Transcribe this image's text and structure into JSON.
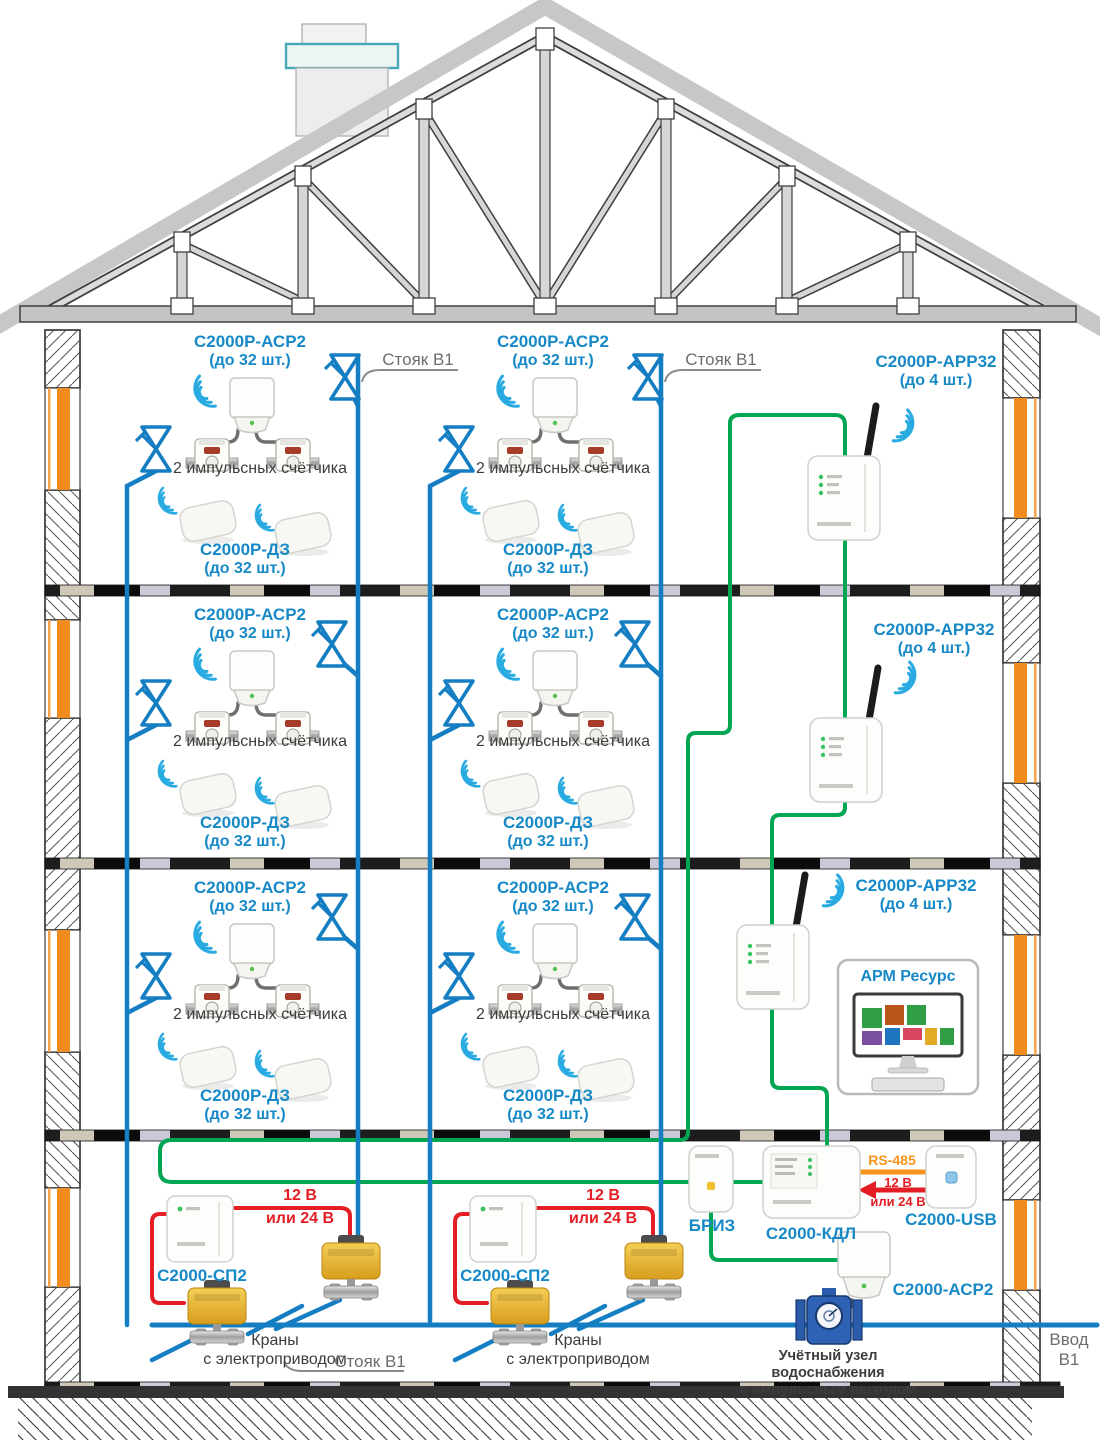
{
  "title": "Схема радиоканальной системы учёта воды в многоэтажном доме",
  "texts": {
    "acp2": "С2000Р-АСР2",
    "qty_32": "(до 32 шт.)",
    "meters": "2 импульсных счётчика",
    "dz": "С2000Р-ДЗ",
    "riser": "Стояк В1",
    "app32": "С2000Р-АРР32",
    "qty_4": "(до 4 шт.)",
    "arm": "АРМ Ресурс",
    "sp2": "С2000-СП2",
    "v12": "12 В",
    "v24": "или 24 В",
    "valves_1": "Краны",
    "valves_2": "с электроприводом",
    "briz": "БРИЗ",
    "kdl": "С2000-КДЛ",
    "rs485": "RS-485",
    "usb": "С2000-USB",
    "acp2_entry": "С2000-АСР2",
    "entry_unit_1": "Учётный узел водоснабжения",
    "entry_unit_2": "с импульсным выходом",
    "entry": "Ввод В1"
  },
  "colors": {
    "label_blue": "#1789c7",
    "label_gray": "#6d6d6d",
    "label_dark": "#3c3c3c",
    "pipe_blue": "#157ec2",
    "wire_green": "#00a651",
    "wire_red": "#e31e24",
    "rs485_orange": "#f7941d",
    "window_orange": "#f08c1e",
    "actuator_yellow": "#e8b838",
    "meter_blue": "#2e62b4",
    "wifi_blue": "#29abe2"
  },
  "icons": {
    "wifi-icon": "three concentric radio arcs",
    "valve-icon": "bowtie shut-off valve with stem",
    "motor-valve-icon": "yellow electric actuator ball valve",
    "water-meter-icon": "impulse water meter",
    "flow-meter-icon": "flanged building water meter",
    "monitor-icon": "desktop PC with tile dashboard"
  }
}
